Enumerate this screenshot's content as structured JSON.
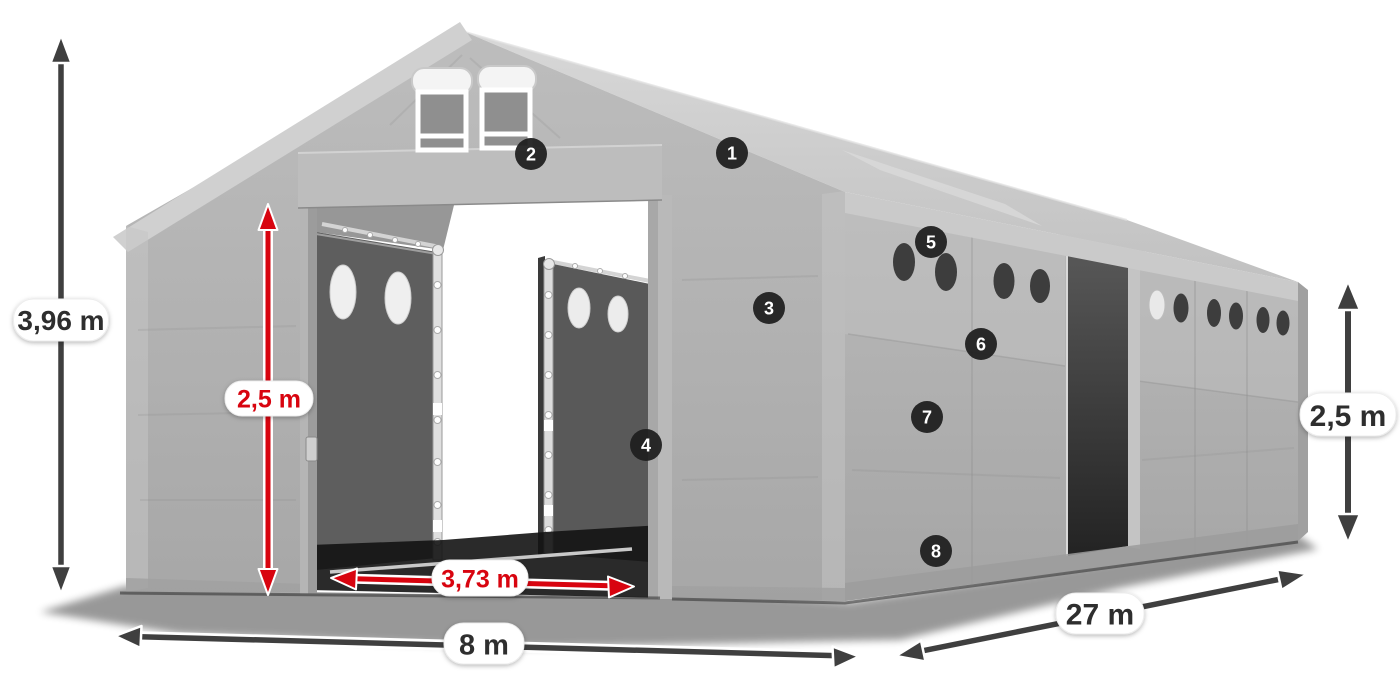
{
  "dimension_labels": {
    "total_height": "3,96 m",
    "entrance_inner_height": "2,5 m",
    "entrance_width": "3,73 m",
    "front_width": "8 m",
    "side_length": "27 m",
    "side_wall_height": "2,5 m"
  },
  "callout_badges": [
    {
      "number": "1"
    },
    {
      "number": "2"
    },
    {
      "number": "3"
    },
    {
      "number": "4"
    },
    {
      "number": "5"
    },
    {
      "number": "6"
    },
    {
      "number": "7"
    },
    {
      "number": "8"
    }
  ],
  "colors": {
    "highlight_red": "#d8040f",
    "dimension_arrow_dark": "#3f3f3f",
    "badge_background": "#1f1f1f",
    "badge_text": "#ffffff",
    "label_pill_background": "#ffffff",
    "label_text_dark": "#2e2e2e",
    "tent_fabric_gray": "#b3b3b3"
  }
}
